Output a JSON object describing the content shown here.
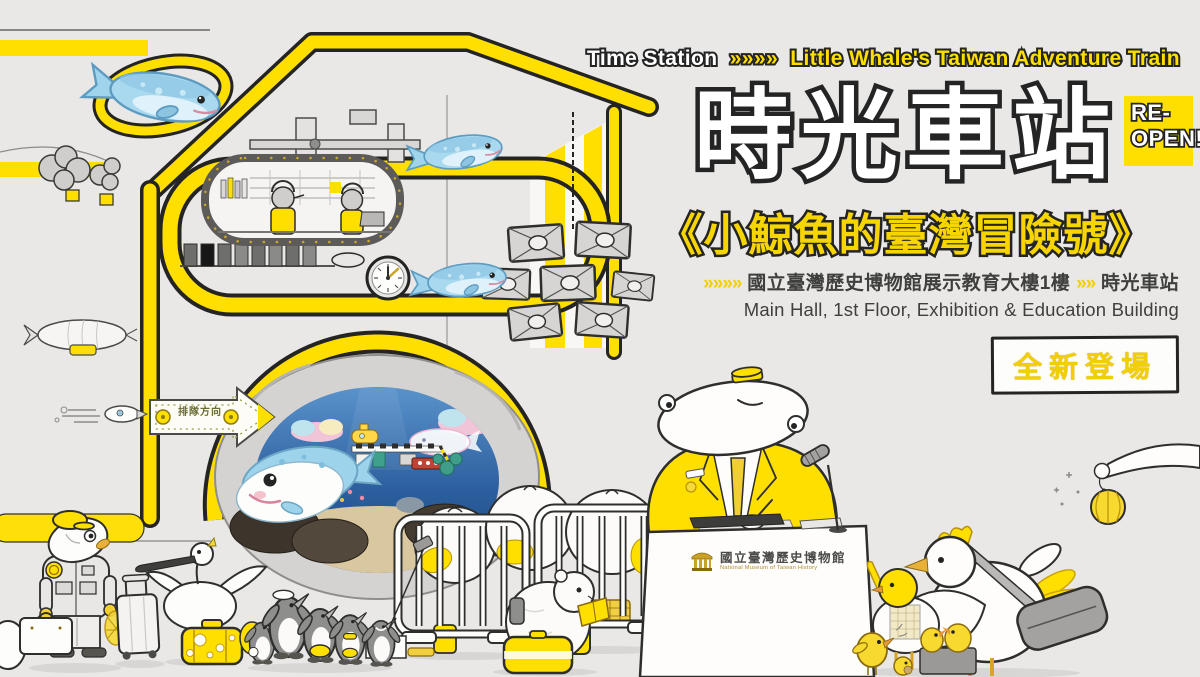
{
  "colors": {
    "background": "#e9e8e6",
    "accent_yellow": "#ffdf00",
    "ink": "#242424",
    "whale_blue": "#a8d9ef",
    "ocean_blue": "#2f66a8",
    "rock_gray": "#d4d3d1"
  },
  "header": {
    "tagline": {
      "left": "Time Station",
      "chevrons": "»»»»",
      "right": "Little Whale's Taiwan Adventure Train"
    },
    "title_zh": "時光車站",
    "reopen": {
      "line1": "RE-",
      "line2": "OPEN!"
    },
    "subtitle_zh": "《小鯨魚的臺灣冒險號》",
    "location": {
      "chevrons_lead": "»»»»",
      "venue_zh": "國立臺灣歷史博物館展示教育大樓1樓",
      "chevrons_mid": "»»",
      "station_zh": "時光車站",
      "venue_en": "Main Hall, 1st Floor, Exhibition & Education Building"
    },
    "new_badge": "全新登場"
  },
  "illustration": {
    "arrow_sign_label": "排隊方向",
    "podium_logo": {
      "name_zh": "國立臺灣歷史博物館",
      "name_en": "National Museum of Taiwan History"
    },
    "elements": [
      "station-house",
      "time-train-control-room",
      "blue-whales",
      "hanging-speakers",
      "wall-clock",
      "undersea-cave-portal",
      "queue-direction-arrow",
      "rocket",
      "airship",
      "steam-clouds",
      "fish-stationmaster",
      "rolling-suitcase",
      "black-faced-spoonbill",
      "cheese-suitcase",
      "penguin-tourists",
      "queue-barriers",
      "luggage-sacks",
      "reading-animal",
      "information-podium",
      "hammerhead-conductor",
      "microphone",
      "chicken-family",
      "hand-with-yarn-ball"
    ]
  }
}
